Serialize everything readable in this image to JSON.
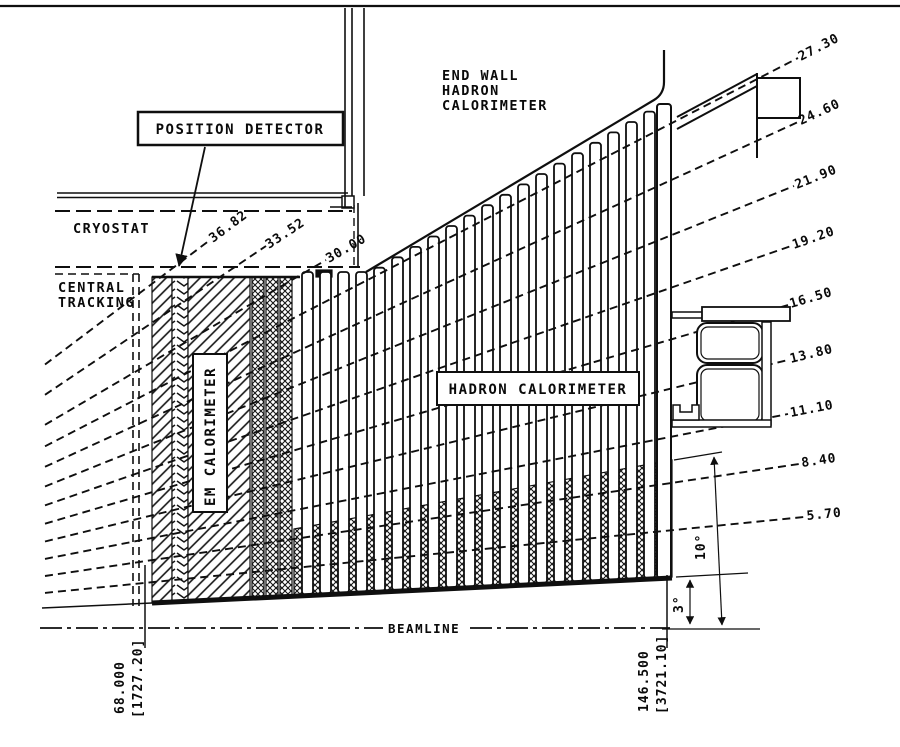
{
  "labels": {
    "position_detector": "POSITION DETECTOR",
    "cryostat": "CRYOSTAT",
    "central_tracking": [
      "CENTRAL",
      "TRACKING"
    ],
    "end_wall": [
      "END WALL",
      "HADRON",
      "CALORIMETER"
    ],
    "em_calorimeter": "EM CALORIMETER",
    "hadron_calorimeter": "HADRON CALORIMETER",
    "beamline": "BEAMLINE"
  },
  "fan": {
    "origin": {
      "x": -307,
      "y": 628
    },
    "start_x": 45,
    "lines": [
      {
        "label": "36.82",
        "angle": 36.82,
        "end": {
          "x": 210,
          "y": 240
        }
      },
      {
        "label": "33.52",
        "angle": 33.52,
        "end": {
          "x": 266,
          "y": 246
        }
      },
      {
        "label": "30.00",
        "angle": 30.0,
        "end": {
          "x": 326,
          "y": 260
        }
      },
      {
        "label": "27.30",
        "angle": 27.3,
        "end": {
          "x": 798,
          "y": 58
        }
      },
      {
        "label": "24.60",
        "angle": 24.6,
        "end": {
          "x": 798,
          "y": 122
        }
      },
      {
        "label": "21.90",
        "angle": 21.9,
        "end": {
          "x": 794,
          "y": 186
        }
      },
      {
        "label": "19.20",
        "angle": 19.2,
        "end": {
          "x": 791,
          "y": 246
        }
      },
      {
        "label": "16.50",
        "angle": 16.5,
        "end": {
          "x": 788,
          "y": 305
        }
      },
      {
        "label": "13.80",
        "angle": 13.8,
        "end": {
          "x": 788,
          "y": 360
        }
      },
      {
        "label": "11.10",
        "angle": 11.1,
        "end": {
          "x": 788,
          "y": 414
        }
      },
      {
        "label": "8.40",
        "angle": 8.4,
        "end": {
          "x": 799,
          "y": 464
        }
      },
      {
        "label": "5.70",
        "angle": 5.7,
        "end": {
          "x": 804,
          "y": 517
        }
      }
    ]
  },
  "dimensions": {
    "left_inches": "68.000",
    "left_mm": "[1727.20]",
    "right_inches": "146.500",
    "right_mm": "[3721.10]",
    "upper_angle": "10°",
    "lower_angle": "3°"
  },
  "colors": {
    "ink": "#0a0a0a",
    "paper": "#ffffff"
  }
}
